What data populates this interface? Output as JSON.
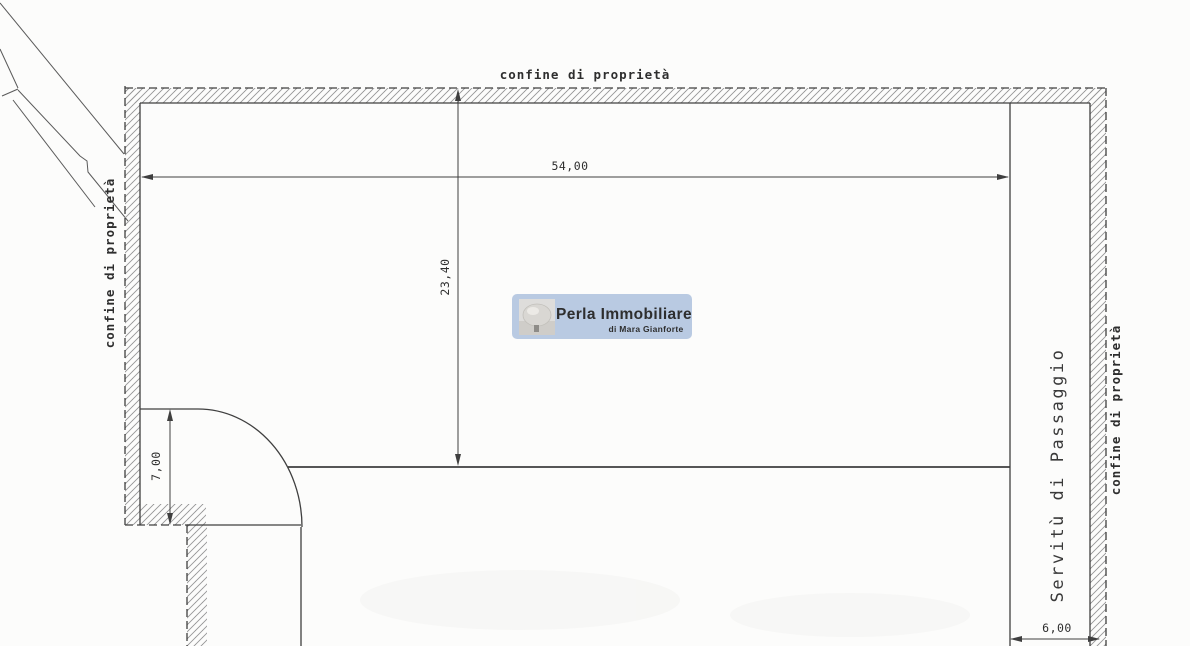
{
  "drawing": {
    "labels": {
      "boundary_top": "confine di proprietà",
      "boundary_left": "confine di proprietà",
      "boundary_right": "confine di proprietà",
      "servitude": "Servitù di Passaggio"
    },
    "dimensions": {
      "plot_width": "54,00",
      "plot_depth": "23,40",
      "left_setback": "7,00",
      "passage_width": "6,00"
    }
  },
  "watermark": {
    "name": "Perla Immobiliare",
    "subtitle": "di Mara Gianforte",
    "logo": "pearl-photo-icon",
    "box_color": "#b3c5e0",
    "text_color": "#e9eef8"
  },
  "colors": {
    "line": "#3f3f3f",
    "hatch": "#969696",
    "text": "#2e2e2e",
    "paper": "#fcfcfb"
  }
}
